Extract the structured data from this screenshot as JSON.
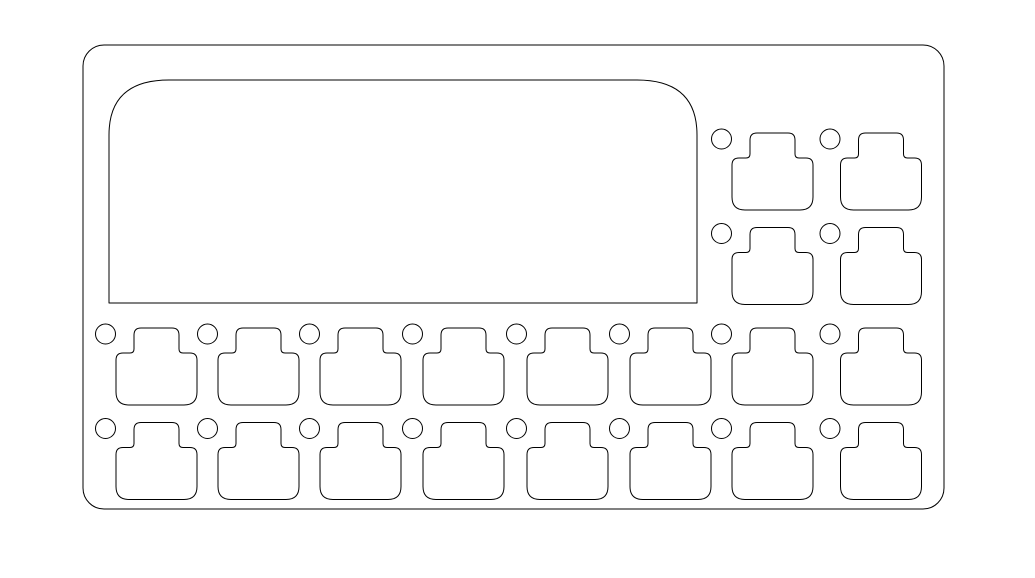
{
  "drawing": {
    "kind": "plate-cutout-line-drawing",
    "colors": {
      "background": "#ffffff",
      "line": "#000000"
    },
    "stroke_width": 1,
    "canvas": {
      "width": 1035,
      "height": 578
    },
    "board_outline": {
      "x": 83,
      "y": 45,
      "width": 861,
      "height": 464,
      "corner_radius": 21
    },
    "screen_cutout": {
      "x": 109,
      "y": 80,
      "width": 588,
      "height": 223,
      "top_left_radius_x": 60,
      "top_left_radius_y": 55,
      "top_right_radius_x": 60,
      "top_right_radius_y": 55,
      "bottom_corner_radius": 0
    },
    "key_shape": {
      "base_width": 81,
      "base_height": 52,
      "tab_width": 45,
      "tab_height": 25,
      "tab_corner_radius": 7,
      "base_top_corner_radius": 7,
      "base_bottom_corner_radius": 13,
      "neck_fillet_radius": 4,
      "total_height": 77
    },
    "grid": {
      "column_x": [
        116,
        218,
        320,
        423,
        527,
        630,
        732,
        840.5
      ],
      "row_tab_top_y": [
        133,
        227.5,
        328,
        422.5
      ],
      "rows": [
        {
          "row": 0,
          "columns": [
            6,
            7
          ]
        },
        {
          "row": 1,
          "columns": [
            6,
            7
          ]
        },
        {
          "row": 2,
          "columns": [
            0,
            1,
            2,
            3,
            4,
            5,
            6,
            7
          ]
        },
        {
          "row": 3,
          "columns": [
            0,
            1,
            2,
            3,
            4,
            5,
            6,
            7
          ]
        }
      ]
    },
    "mounting_hole": {
      "diameter": 20,
      "offset_x": -10.5,
      "offset_y": 6
    },
    "counts": {
      "key_cutouts": 20,
      "mounting_holes": 20
    }
  }
}
